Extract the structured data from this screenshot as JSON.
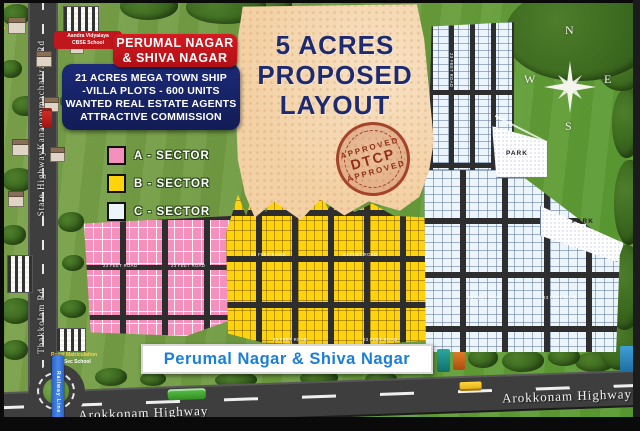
{
  "map": {
    "title_banner": {
      "line1": "PERUMAL NAGAR",
      "line2": "& SHIVA NAGAR"
    },
    "info_box": {
      "line1": "21 ACRES MEGA TOWN SHIP",
      "line2": "-VILLA PLOTS - 600 UNITS",
      "line3": "WANTED REAL ESTATE AGENTS",
      "line4": "ATTRACTIVE COMMISSION"
    },
    "legend": {
      "items": [
        {
          "label": "A - SECTOR",
          "color": "#f590bd"
        },
        {
          "label": "B - SECTOR",
          "color": "#ffd40a"
        },
        {
          "label": "C - SECTOR",
          "color": "#ecf5fb"
        }
      ]
    },
    "proposed": {
      "line1": "5 ACRES",
      "line2": "PROPOSED",
      "line3": "LAYOUT"
    },
    "stamp": {
      "top": "APPROVED",
      "center": "DTCP",
      "bottom": "APPROVED"
    },
    "compass": {
      "n": "N",
      "e": "E",
      "s": "S",
      "w": "W"
    },
    "parks": {
      "park1": "PARK",
      "park2": "PARK"
    },
    "roads": {
      "kanagammachatiram": "Kanagammachatiram Rd",
      "state_highway": "State Highway",
      "thakkolam": "Thakkolam Rd",
      "arokkonam_left": "Arokkonam Highway",
      "arokkonam_right": "Arokkonam Highway",
      "ribbon": "Railway Line",
      "plot_road": "23 FEET ROAD"
    },
    "landmarks": {
      "school_top_line1": "Aandra Vidyalaya",
      "school_top_line2": "CBSE School",
      "school_bottom_line1": "Royal Matriculation",
      "school_bottom_line2": "Hr.Sec School",
      "temple": "Arulmigu Kovil"
    },
    "bottom_banner": "Perumal Nagar & Shiva Nagar",
    "colors": {
      "banner_red": "#c0161c",
      "info_navy": "#18246b",
      "banner_blue_text": "#1b7fd8",
      "stamp_red": "#8f3018",
      "proposed_tan": "#f3d1a5",
      "grass_green": "#6f9a40",
      "road_gray": "#3e3e3e"
    }
  }
}
